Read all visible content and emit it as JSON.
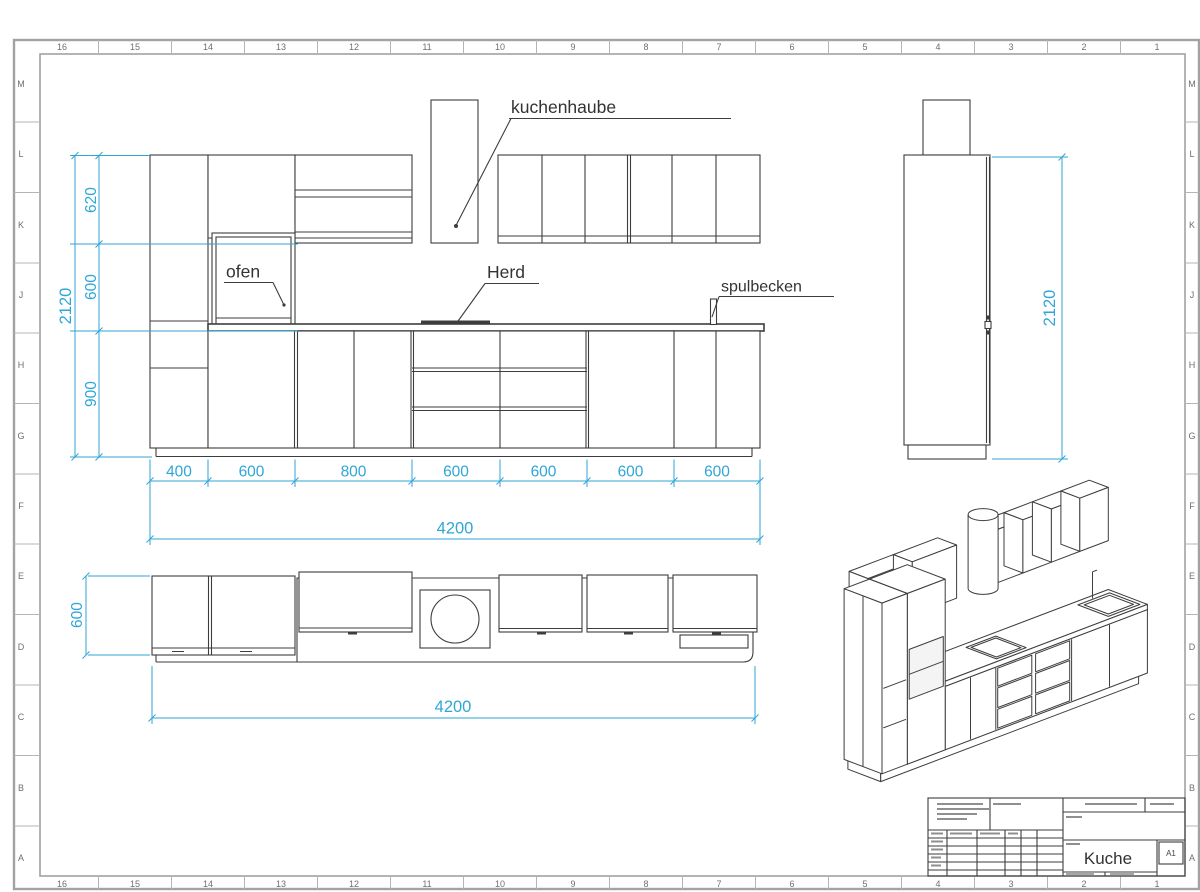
{
  "sheet": {
    "grid_columns": [
      "16",
      "15",
      "14",
      "13",
      "12",
      "11",
      "10",
      "9",
      "8",
      "7",
      "6",
      "5",
      "4",
      "3",
      "2",
      "1"
    ],
    "grid_rows": [
      "M",
      "L",
      "K",
      "J",
      "H",
      "G",
      "F",
      "E",
      "D",
      "C",
      "B",
      "A"
    ]
  },
  "labels": {
    "hood": "kuchenhaube",
    "oven": "ofen",
    "stove": "Herd",
    "sink": "spulbecken"
  },
  "dimensions": {
    "front_heights": [
      "620",
      "600",
      "900"
    ],
    "front_total_height": "2120",
    "front_widths": [
      "400",
      "600",
      "800",
      "600",
      "600",
      "600",
      "600"
    ],
    "front_total_width": "4200",
    "side_height": "2120",
    "plan_depth": "600",
    "plan_width": "4200"
  },
  "title_block": {
    "drawing_title": "Kuche",
    "sheet_format": "A1"
  },
  "colors": {
    "dimension": "#2fa6d6",
    "line": "#3d3d3d",
    "frame": "#a2a2a2"
  }
}
